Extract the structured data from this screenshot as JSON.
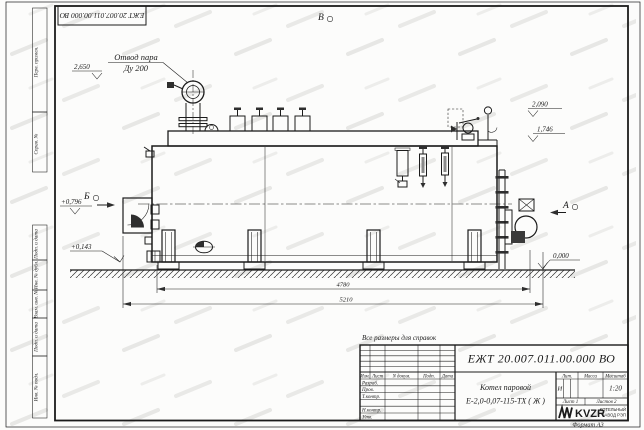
{
  "frame": {
    "designation_top": "ЕЖТ 20.007.011.00.000 ВО",
    "note": "Все размеры для справок",
    "format": "Формат А3",
    "side_labels": [
      "Перв. примен.",
      "Справ. №",
      "Подп. и дата",
      "Инв. № дубл.",
      "Взам. инв. №",
      "Подп. и дата",
      "Инв. № подл."
    ]
  },
  "annotations": {
    "label_steam_line1": "Отвод пара",
    "label_steam_line2": "Ду 200",
    "view_top": "В",
    "view_front": "Б",
    "view_rear": "А",
    "elev_2650": "2,650",
    "elev_2090": "2,090",
    "elev_1746": "1,746",
    "elev_0796": "+0,796",
    "elev_0143": "+0,143",
    "elev_0000": "0,000",
    "dim_4780": "4780",
    "dim_5210": "5210"
  },
  "title_block": {
    "designation": "ЕЖТ 20.007.011.00.000 ВО",
    "name_line1": "Котел паровой",
    "name_line2": "Е-2,0-0,07-115-ТХ ( Ж )",
    "col_izm": "Изм.",
    "col_list": "Лист",
    "col_doc": "N докум.",
    "col_podp": "Подп.",
    "col_data": "Дата",
    "row_razrab": "Разраб.",
    "row_prov": "Пров.",
    "row_tkontr": "Т.контр.",
    "row_nkontr": "Н.контр.",
    "row_utv": "Утв.",
    "lit_header": "Лит.",
    "mass_header": "Масса",
    "scale_header": "Масштаб",
    "lit": "И",
    "scale": "1:20",
    "sheet": "Лист 1",
    "sheets": "Листов 2",
    "logo": "KVZR",
    "logo_sub1": "КОТЕЛЬНЫЙ",
    "logo_sub2": "ЗАВОД РЭП"
  }
}
